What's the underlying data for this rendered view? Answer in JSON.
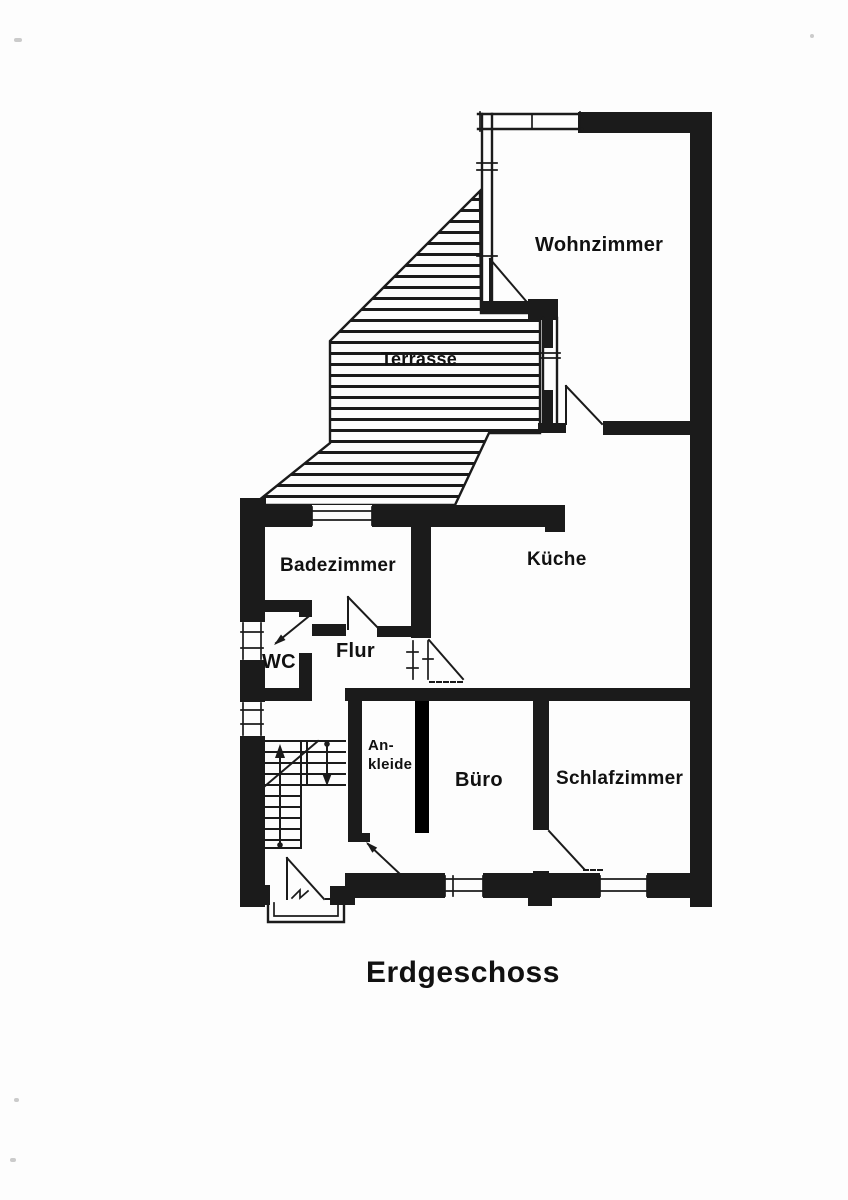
{
  "title": "Erdgeschoss",
  "rooms": {
    "wohnzimmer": "Wohnzimmer",
    "terrasse": "Terrasse",
    "kueche": "Küche",
    "badezimmer": "Badezimmer",
    "wc": "WC",
    "flur": "Flur",
    "ankleide": "An-\nkleide",
    "buero": "Büro",
    "schlafzimmer": "Schlafzimmer"
  },
  "colors": {
    "ink": "#1b1b1b",
    "paper": "#fdfdfd",
    "highlight_wall": "#000000"
  }
}
